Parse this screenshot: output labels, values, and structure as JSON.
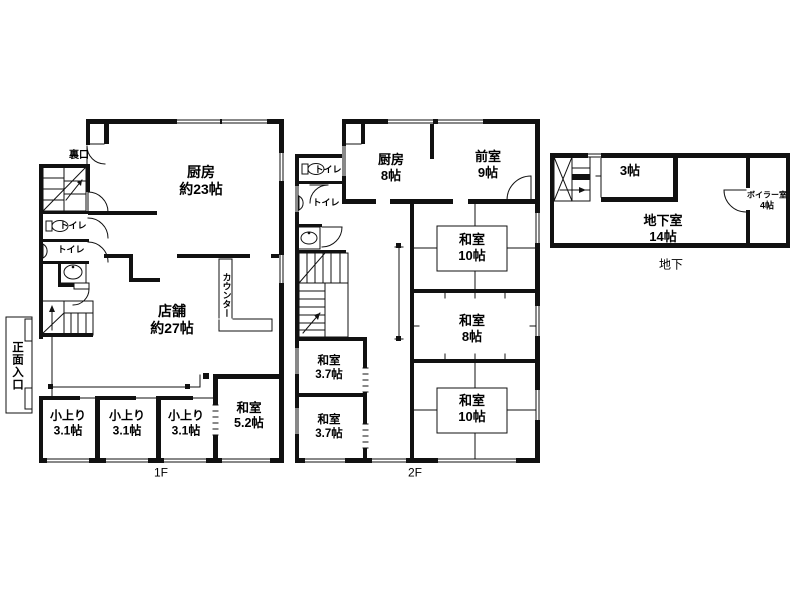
{
  "colors": {
    "wall": "#111111",
    "bg": "#ffffff"
  },
  "f1": {
    "floor_label": "1F",
    "kitchen": {
      "l1": "厨房",
      "l2": "約23帖"
    },
    "shop": {
      "l1": "店舗",
      "l2": "約27帖"
    },
    "counter": "カウンター",
    "entrance": "正面入口",
    "backdoor": "裏口",
    "toilets": [
      {
        "label": "トイレ"
      },
      {
        "label": "トイレ"
      }
    ],
    "koagari": [
      {
        "l1": "小上り",
        "l2": "3.1帖"
      },
      {
        "l1": "小上り",
        "l2": "3.1帖"
      },
      {
        "l1": "小上り",
        "l2": "3.1帖"
      }
    ],
    "washitsu52": {
      "l1": "和室",
      "l2": "5.2帖"
    }
  },
  "f2": {
    "floor_label": "2F",
    "kitchen": {
      "l1": "厨房",
      "l2": "8帖"
    },
    "zenshitsu": {
      "l1": "前室",
      "l2": "9帖"
    },
    "toilets": [
      {
        "label": "トイレ"
      },
      {
        "label": "トイレ"
      }
    ],
    "washitsu10a": {
      "l1": "和室",
      "l2": "10帖"
    },
    "washitsu8": {
      "l1": "和室",
      "l2": "8帖"
    },
    "washitsu10b": {
      "l1": "和室",
      "l2": "10帖"
    },
    "washitsu37a": {
      "l1": "和室",
      "l2": "3.7帖"
    },
    "washitsu37b": {
      "l1": "和室",
      "l2": "3.7帖"
    }
  },
  "basement": {
    "floor_label": "地下",
    "room3": "3帖",
    "chikashitsu": {
      "l1": "地下室",
      "l2": "14帖"
    },
    "boiler": {
      "l1": "ボイラー室",
      "l2": "4帖"
    }
  }
}
